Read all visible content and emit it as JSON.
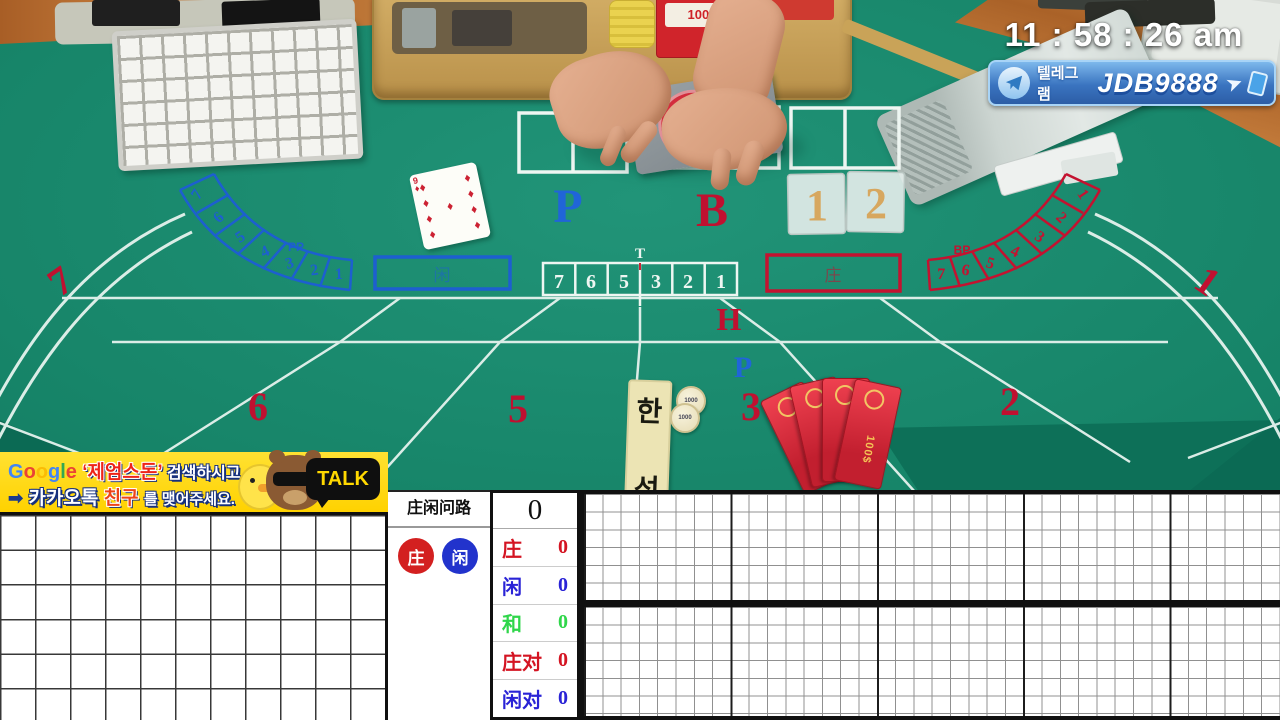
{
  "clock": {
    "time": "11 : 58 : 26 am"
  },
  "telegram_banner": {
    "label": "텔레그램",
    "handle": "JDB9888"
  },
  "kakao_banner": {
    "google_letters": [
      "G",
      "o",
      "o",
      "g",
      "l",
      "e"
    ],
    "quote": "‘제엄스돈’",
    "line1_rest": "검색하시고",
    "arrow": "➡",
    "kakao_word": "카카오톡",
    "friend_word": "친구",
    "line2_rest": "를 맺어주세요.",
    "talk": "TALK"
  },
  "table": {
    "player_letter": "P",
    "banker_letter": "B",
    "h_marker": "H",
    "p_marker": "P",
    "tip_label": "T",
    "tip_numbers": [
      "7",
      "6",
      "5",
      "3",
      "2",
      "1"
    ],
    "player_arc_label": "PP",
    "player_arc_numbers": [
      "7",
      "6",
      "5",
      "4",
      "3",
      "2",
      "1"
    ],
    "banker_arc_label": "BP",
    "banker_arc_numbers": [
      "1",
      "2",
      "3",
      "4",
      "5",
      "6",
      "7"
    ],
    "seat_numbers": [
      "7",
      "6",
      "5",
      "3",
      "2",
      "1"
    ],
    "plaque_numbers": [
      "1",
      "2"
    ],
    "player_box_glyph": "闲",
    "banker_box_glyph": "庄",
    "card": {
      "rank": "9",
      "suit": "♦"
    },
    "chip_value": "1000",
    "voucher_label": "100$",
    "tray_box_label": "100s",
    "deck_box_label": "BAC",
    "korean_plaque": [
      "한",
      "성"
    ]
  },
  "scoreboard": {
    "road_title": "庄闲问路",
    "banker_badge": "庄",
    "player_badge": "闲",
    "total": "0",
    "rows": [
      {
        "label": "庄",
        "value": "0",
        "color": "#d41422"
      },
      {
        "label": "闲",
        "value": "0",
        "color": "#2a23d6"
      },
      {
        "label": "和",
        "value": "0",
        "color": "#2fd64a"
      },
      {
        "label": "庄对",
        "value": "0",
        "color": "#d41422"
      },
      {
        "label": "闲对",
        "value": "0",
        "color": "#2a23d6"
      }
    ]
  }
}
